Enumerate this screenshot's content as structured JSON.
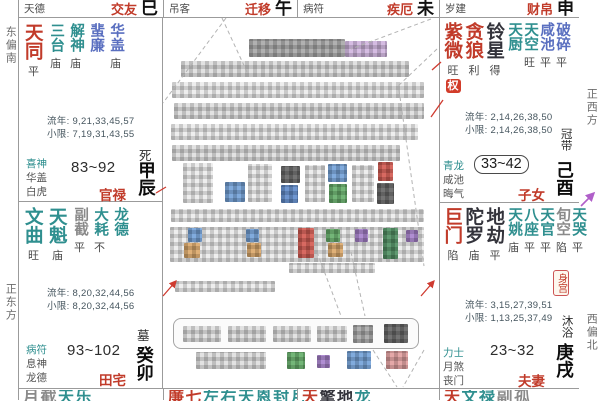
{
  "compass": {
    "left_top": "东偏南",
    "left_bottom": "正东方",
    "right_top": "正西方",
    "right_bottom": "西偏北"
  },
  "top_strip": [
    {
      "label": "天德",
      "palace": "交友",
      "branch": "巳"
    },
    {
      "label": "吊客",
      "palace": "迁移",
      "branch": "午"
    },
    {
      "label": "病符",
      "palace": "疾厄",
      "branch": "未"
    },
    {
      "label": "岁建",
      "palace": "财帛",
      "branch": "申"
    }
  ],
  "palace_chen": {
    "stars": [
      {
        "name": "天同",
        "cls": "r big",
        "bright": "平",
        "hua": ""
      },
      {
        "name": "三台",
        "cls": "t",
        "bright": "庙",
        "hua": ""
      },
      {
        "name": "解神",
        "cls": "t",
        "bright": "庙",
        "hua": ""
      },
      {
        "name": "蜚廉",
        "cls": "b",
        "bright": "",
        "hua": ""
      },
      {
        "name": "华盖",
        "cls": "b",
        "bright": "庙",
        "hua": ""
      }
    ],
    "liunian": "流年: 9,21,33,45,57",
    "xiaoxian": "小限: 7,19,31,43,55",
    "stage": "死",
    "shensha": [
      "喜神",
      "华盖",
      "白虎"
    ],
    "ages": "83~92",
    "name": "官禄",
    "ganzhi": "甲辰"
  },
  "palace_mao": {
    "stars": [
      {
        "name": "文曲",
        "cls": "t big",
        "bright": "旺",
        "hua": ""
      },
      {
        "name": "天魁",
        "cls": "t big",
        "bright": "庙",
        "hua": ""
      },
      {
        "name": "副截",
        "cls": "g",
        "bright": "平",
        "hua": ""
      },
      {
        "name": "大耗",
        "cls": "t",
        "bright": "不",
        "hua": ""
      },
      {
        "name": "龙德",
        "cls": "t",
        "bright": "",
        "hua": ""
      }
    ],
    "liunian": "流年: 8,20,32,44,56",
    "xiaoxian": "小限: 8,20,32,44,56",
    "stage": "墓",
    "shensha": [
      "病符",
      "息神",
      "龙德"
    ],
    "ages": "93~102",
    "name": "田宅",
    "ganzhi": "癸卯"
  },
  "palace_you": {
    "stars": [
      {
        "name": "紫微",
        "cls": "r big",
        "bright": "旺",
        "hua": "权"
      },
      {
        "name": "贪狼",
        "cls": "r big",
        "bright": "利",
        "hua": ""
      },
      {
        "name": "铃星",
        "cls": "k big",
        "bright": "得",
        "hua": ""
      },
      {
        "name": "天厨",
        "cls": "t",
        "bright": "",
        "hua": ""
      },
      {
        "name": "天空",
        "cls": "t",
        "bright": "旺",
        "hua": ""
      },
      {
        "name": "咸池",
        "cls": "b",
        "bright": "平",
        "hua": ""
      },
      {
        "name": "破碎",
        "cls": "b",
        "bright": "平",
        "hua": ""
      }
    ],
    "liunian": "流年: 2,14,26,38,50",
    "xiaoxian": "小限: 2,14,26,38,50",
    "stage": "冠带",
    "shensha": [
      "青龙",
      "咸池",
      "晦气"
    ],
    "ages": "33~42",
    "name": "子女",
    "ganzhi": "己酉"
  },
  "palace_xu": {
    "stars": [
      {
        "name": "巨门",
        "cls": "r big",
        "bright": "陷",
        "hua": ""
      },
      {
        "name": "陀罗",
        "cls": "k big",
        "bright": "庙",
        "hua": ""
      },
      {
        "name": "地劫",
        "cls": "k big",
        "bright": "平",
        "hua": ""
      },
      {
        "name": "天姚",
        "cls": "t",
        "bright": "庙",
        "hua": ""
      },
      {
        "name": "八座",
        "cls": "t",
        "bright": "平",
        "hua": ""
      },
      {
        "name": "天官",
        "cls": "t",
        "bright": "平",
        "hua": ""
      },
      {
        "name": "旬空",
        "cls": "g",
        "bright": "陷",
        "hua": ""
      },
      {
        "name": "天哭",
        "cls": "t",
        "bright": "平",
        "hua": ""
      }
    ],
    "body_badge": "身宫",
    "liunian": "流年: 3,15,27,39,51",
    "xiaoxian": "小限: 1,13,25,37,49",
    "stage": "沐浴",
    "shensha": [
      "力士",
      "月煞",
      "丧门"
    ],
    "ages": "23~32",
    "name": "夫妻",
    "ganzhi": "庚戌"
  },
  "bottom_strip": {
    "yin": [
      {
        "ch": "月",
        "cls": "g"
      },
      {
        "ch": "截",
        "cls": "g"
      },
      {
        "ch": "天",
        "cls": "t"
      },
      {
        "ch": "乐",
        "cls": "t"
      }
    ],
    "chou": [
      {
        "ch": "廉",
        "cls": "r"
      },
      {
        "ch": "七",
        "cls": "r"
      },
      {
        "ch": "左",
        "cls": "t"
      },
      {
        "ch": "右",
        "cls": "t"
      },
      {
        "ch": "天",
        "cls": "t"
      },
      {
        "ch": "恩",
        "cls": "t"
      },
      {
        "ch": "封",
        "cls": "t"
      },
      {
        "ch": "月",
        "cls": "t"
      }
    ],
    "zi": [
      {
        "ch": "天",
        "cls": "r"
      },
      {
        "ch": "擎",
        "cls": "k"
      },
      {
        "ch": "地",
        "cls": "k"
      },
      {
        "ch": "龙",
        "cls": "t"
      }
    ],
    "hai": [
      {
        "ch": "天",
        "cls": "r"
      },
      {
        "ch": "文",
        "cls": "t"
      },
      {
        "ch": "禄",
        "cls": "t"
      },
      {
        "ch": "副",
        "cls": "g"
      },
      {
        "ch": "孤",
        "cls": "g"
      }
    ]
  },
  "colors": {
    "palace_red": "#c13b2a",
    "star_teal": "#2f8f8f",
    "star_blue": "#5a6fc0",
    "hua_badge_bg": "#d23c2a",
    "grid_line": "#9b9b9b",
    "purple_arrow": "#b05fc9"
  }
}
